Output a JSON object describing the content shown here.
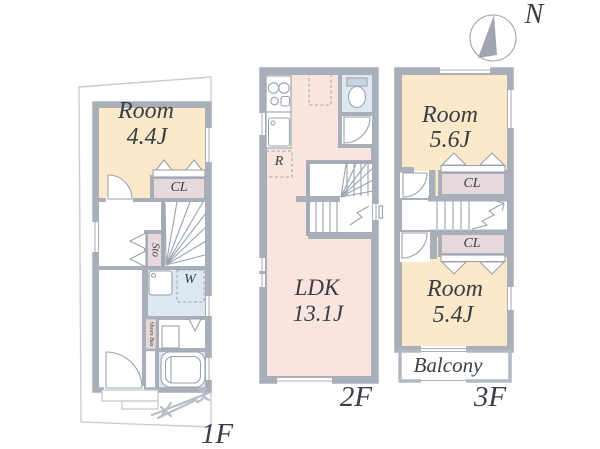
{
  "compass": {
    "north_label": "N"
  },
  "colors": {
    "wall": "#A9AFB9",
    "room_cream": "#FBE9C9",
    "ldk_pink": "#F9E4DE",
    "closet_pink": "#E7D9DB",
    "wet_blue": "#DCE7F1",
    "line": "#9AA3AE"
  },
  "floor_1f": {
    "floor_label": "1F",
    "room": {
      "name": "Room",
      "area": "4.4J"
    },
    "closet_label": "CL",
    "storage_label": "Sto",
    "washer_label": "W",
    "shoes_box_label": "Shoes Box"
  },
  "floor_2f": {
    "floor_label": "2F",
    "ldk": {
      "name": "LDK",
      "area": "13.1J"
    },
    "refrigerator_label": "R"
  },
  "floor_3f": {
    "floor_label": "3F",
    "room_north": {
      "name": "Room",
      "area": "5.6J"
    },
    "room_south": {
      "name": "Room",
      "area": "5.4J"
    },
    "closet_north_label": "CL",
    "closet_south_label": "CL",
    "balcony_label": "Balcony"
  }
}
